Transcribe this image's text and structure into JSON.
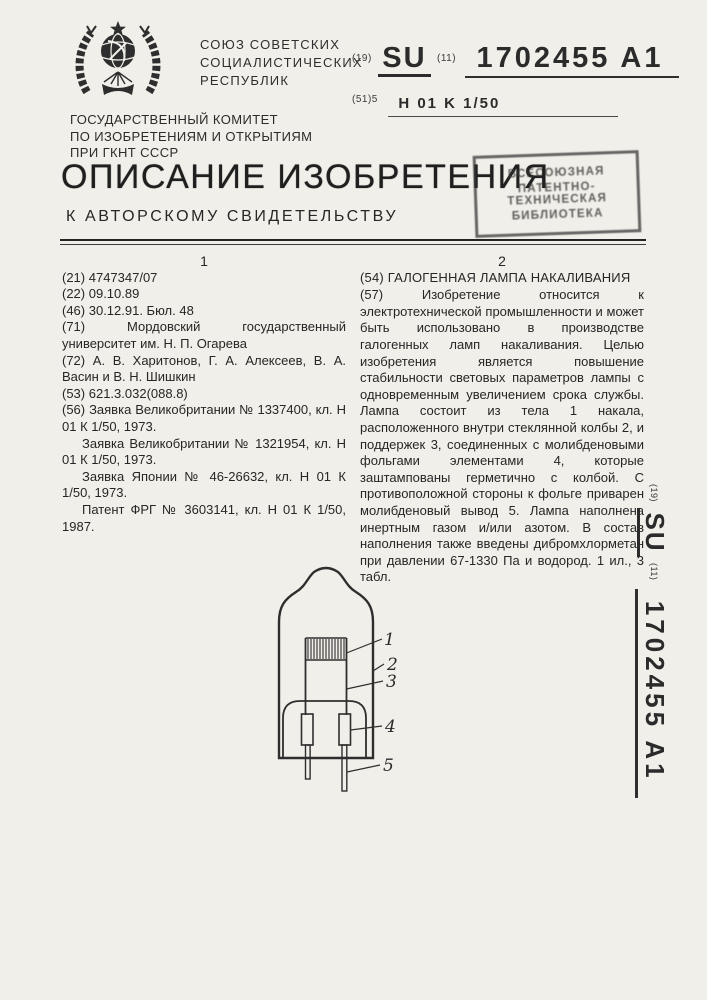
{
  "header": {
    "country_lines": [
      "СОЮЗ СОВЕТСКИХ",
      "СОЦИАЛИСТИЧЕСКИХ",
      "РЕСПУБЛИК"
    ],
    "code19_label": "(19)",
    "country_code": "SU",
    "code11_label": "(11)",
    "publication_number": "1702455 A1",
    "code51_label": "(51)5",
    "ipc_class": "H 01 K 1/50",
    "committee_lines": [
      "ГОСУДАРСТВЕННЫЙ КОМИТЕТ",
      "ПО ИЗОБРЕТЕНИЯМ И ОТКРЫТИЯМ",
      "ПРИ ГКНТ СССР"
    ],
    "doc_title": "ОПИСАНИЕ ИЗОБРЕТЕНИЯ",
    "doc_subtitle": "К АВТОРСКОМУ СВИДЕТЕЛЬСТВУ",
    "stamp_lines": [
      "ВСЕСОЮЗНАЯ",
      "ПАТЕНТНО-ТЕХНИЧЕСКАЯ",
      "БИБЛИОТЕКА"
    ]
  },
  "left_column": {
    "page_marker": "1",
    "items": [
      "(21) 4747347/07",
      "(22) 09.10.89",
      "(46) 30.12.91. Бюл. 48",
      "(71) Мордовский государственный университет им. Н. П. Огарева",
      "(72) А. В. Харитонов, Г. А. Алексеев, В. А. Васин и В. Н. Шишкин",
      "(53) 621.3.032(088.8)",
      "(56) Заявка Великобритании № 1337400, кл. Н 01 К 1/50, 1973.",
      "Заявка Великобритании № 1321954, кл. Н 01 К 1/50, 1973.",
      "Заявка Японии № 46-26632, кл. Н 01 К 1/50, 1973.",
      "Патент ФРГ № 3603141, кл. Н 01 К 1/50, 1987."
    ]
  },
  "right_column": {
    "page_marker": "2",
    "invention_title": "(54) ГАЛОГЕННАЯ ЛАМПА НАКАЛИВАНИЯ",
    "abstract": "(57) Изобретение относится к электротехнической промышленности и может быть использовано в производстве галогенных ламп накаливания. Целью изобретения является повышение стабильности световых параметров лампы с одновременным увеличением срока службы. Лампа состоит из тела 1 накала, расположенного внутри стеклянной колбы 2, и поддержек 3, соединенных с молибденовыми фольгами элементами 4, которые заштампованы герметично с колбой. С противоположной стороны к фольге приварен молибденовый вывод 5. Лампа наполнена инертным газом и/или азотом. В состав наполнения также введены дибромхлорметан при давлении 67-1330 Па и водород. 1 ил., 3 табл."
  },
  "figure": {
    "labels": [
      "1",
      "2",
      "3",
      "4",
      "5"
    ]
  },
  "side_strip": {
    "code19_label": "(19)",
    "country_code": "SU",
    "code11_label": "(11)",
    "publication_number": "1702455 A1"
  }
}
